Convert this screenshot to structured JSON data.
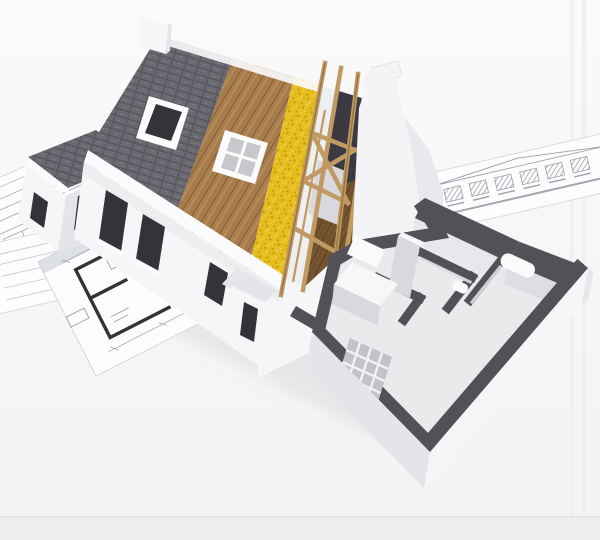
{
  "meta": {
    "type": "3d-architectural-render",
    "description": "Cutaway 3D model of a house under construction standing on architectural blueprint drawings; the roof is peeled back in layers (shingles, wood sheathing, yellow insulation, open rafters) and the ground floor is sliced open showing white walls with dark cut tops, a kitchen and bathroom",
    "width": 600,
    "height": 540
  },
  "palette": {
    "bg_top": "#fafafa",
    "bg_bottom": "#f3f3f4",
    "bottom_strip": "#ededee",
    "edge_line": "#e2e2e3",
    "band": "#ededed",
    "shadow": "#d9d9db",
    "paper": "#fdfdfe",
    "paper_edge": "#d9dbde",
    "paper_line": "#9aa1a9",
    "paper_faint": "#c3c8cf",
    "plan_wall": "#323237",
    "shingle": "#6a6a71",
    "shingle_line": "#56565d",
    "shingle_lite": "#7d7d85",
    "wood": "#aa7e4f",
    "wood_seam": "#8a6236",
    "wood_lite": "#c29a67",
    "insulation": "#e6be20",
    "insulation_dark": "#c39a0d",
    "insulation_lite": "#f3d54e",
    "batten": "#edeff1",
    "rafter": "#c09a62",
    "rafter_dark": "#8f6c3c",
    "attic": "#3a3a40",
    "attic_floor": "#74552f",
    "attic_floor_line": "#5a3f22",
    "bed": "#d9d9dd",
    "white_wall": "#f6f6f8",
    "white_wall_shade": "#e4e5e8",
    "fascia": "#fbfbfd",
    "window_dark": "#33343a",
    "glass": "#c7c8cc",
    "mullion": "#fcfcfd",
    "wall_top": "#515157",
    "wall_top_lite": "#63636a",
    "inner_face": "#e7e8eb",
    "inner_face2": "#dddee2",
    "floor": "#eaeaed",
    "cabinet_top": "#f7f7f9",
    "cabinet_face": "#d8d9dc",
    "glassblock": "#c2c3c8",
    "glassblock_line": "#f2f2f4",
    "fixture": "#fafafb",
    "gable": "#f4f4f6",
    "gable_shade": "#e3e4e8"
  },
  "scene": {
    "elements": [
      {
        "name": "blueprint-floor-plan",
        "desc": "floor plan sheet under the house, lower left"
      },
      {
        "name": "blueprint-sheets-left",
        "desc": "stack of drawing sheets at left edge"
      },
      {
        "name": "blueprint-elevation",
        "desc": "facade elevation sheet at right"
      },
      {
        "name": "roof-shingle-layer",
        "desc": "dark grey shingle band with skylight"
      },
      {
        "name": "roof-sheathing-layer",
        "desc": "brown wood plank band with skylight"
      },
      {
        "name": "roof-insulation-layer",
        "desc": "yellow mineral-wool band"
      },
      {
        "name": "roof-rafters",
        "desc": "exposed timber truss over attic"
      },
      {
        "name": "chimney",
        "desc": "white chimney at ridge"
      },
      {
        "name": "gable-wall",
        "desc": "white chimney-shaped gable end wall"
      },
      {
        "name": "left-wing",
        "desc": "small gabled wing with dark roof"
      },
      {
        "name": "front-wall",
        "desc": "white facade with dark window openings"
      },
      {
        "name": "interior-cutaway",
        "desc": "sliced ground floor: kitchen, bathroom, glass-block wall"
      }
    ]
  }
}
